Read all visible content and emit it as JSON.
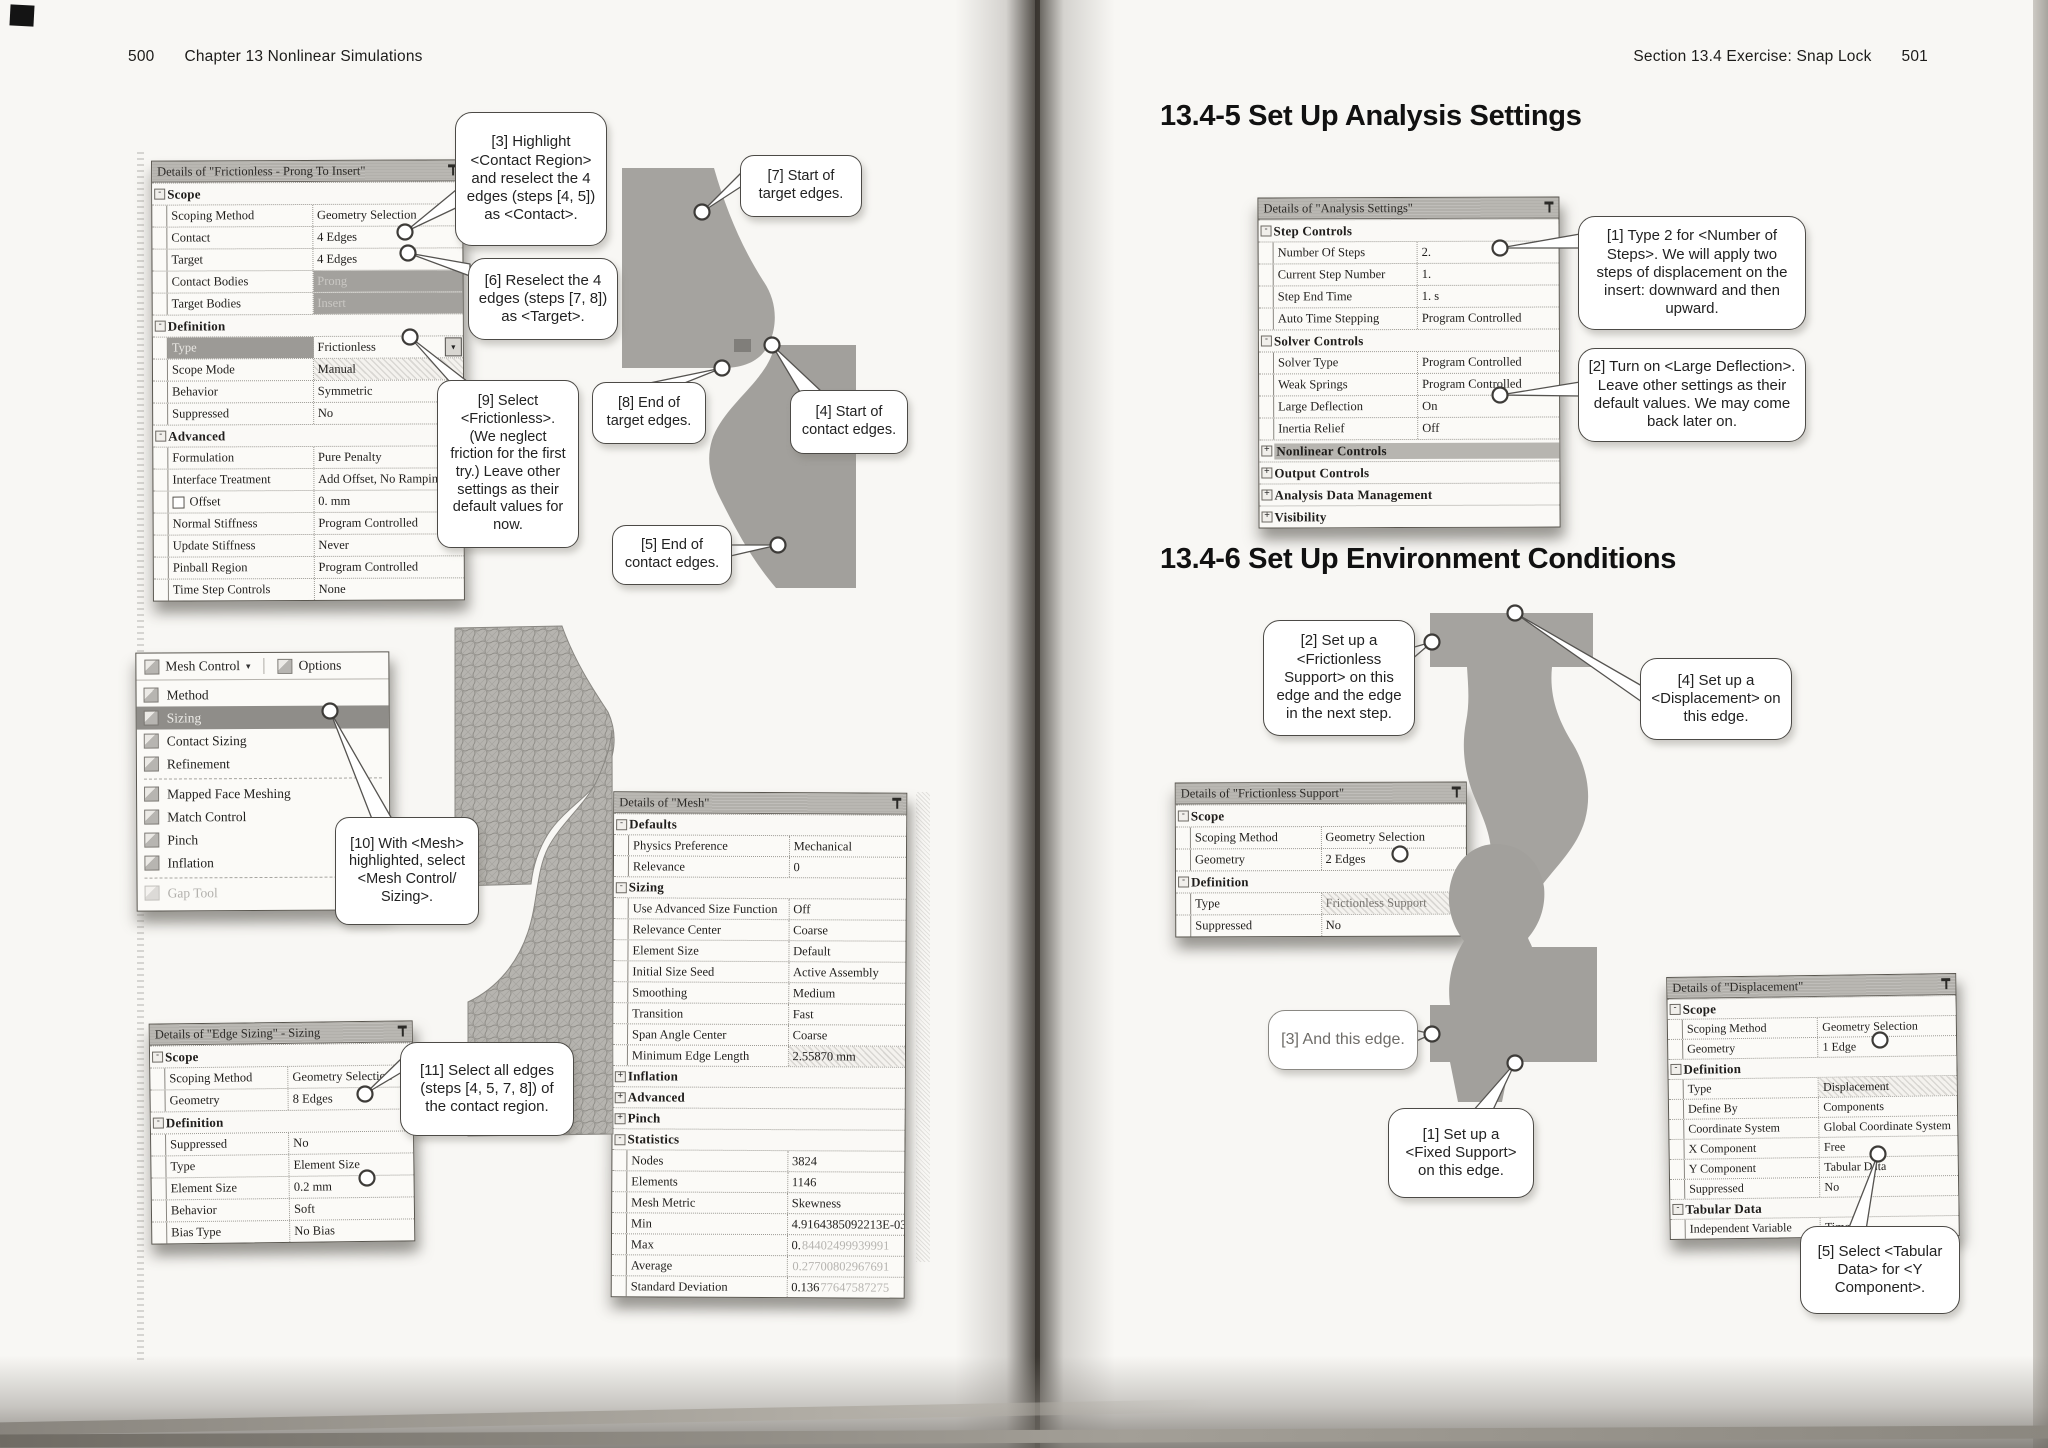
{
  "page_left": {
    "page_number": "500",
    "running_head": "Chapter 13  Nonlinear Simulations"
  },
  "page_right": {
    "running_head": "Section 13.4  Exercise:  Snap Lock",
    "page_number": "501",
    "heading_1345": "13.4-5  Set Up Analysis Settings",
    "heading_1346": "13.4-6  Set Up Environment Conditions"
  },
  "tables": {
    "contact": {
      "title": "Details of \"Frictionless - Prong To Insert\"",
      "rows": [
        {
          "t": "sec",
          "l": "Scope",
          "e": "-"
        },
        {
          "t": "row",
          "l": "Scoping Method",
          "v": "Geometry Selection"
        },
        {
          "t": "row",
          "l": "Contact",
          "v": "4 Edges"
        },
        {
          "t": "row",
          "l": "Target",
          "v": "4 Edges"
        },
        {
          "t": "row",
          "l": "Contact Bodies",
          "v": "Prong",
          "vs": "gray"
        },
        {
          "t": "row",
          "l": "Target Bodies",
          "v": "Insert",
          "vs": "gray"
        },
        {
          "t": "sec",
          "l": "Definition",
          "e": "-"
        },
        {
          "t": "row",
          "l": "Type",
          "v": "Frictionless",
          "lhl": true,
          "dd": true
        },
        {
          "t": "row",
          "l": "Scope Mode",
          "v": "Manual",
          "vs": "hatch"
        },
        {
          "t": "row",
          "l": "Behavior",
          "v": "Symmetric"
        },
        {
          "t": "row",
          "l": "Suppressed",
          "v": "No"
        },
        {
          "t": "sec",
          "l": "Advanced",
          "e": "-"
        },
        {
          "t": "row",
          "l": "Formulation",
          "v": "Pure Penalty"
        },
        {
          "t": "row",
          "l": "Interface Treatment",
          "v": "Add Offset, No Ramping"
        },
        {
          "t": "row",
          "l": "Offset",
          "v": "0. mm",
          "cb": true
        },
        {
          "t": "row",
          "l": "Normal Stiffness",
          "v": "Program Controlled"
        },
        {
          "t": "row",
          "l": "Update Stiffness",
          "v": "Never"
        },
        {
          "t": "row",
          "l": "Pinball Region",
          "v": "Program Controlled"
        },
        {
          "t": "row",
          "l": "Time Step Controls",
          "v": "None"
        }
      ]
    },
    "edge_sizing": {
      "title": "Details of \"Edge Sizing\" - Sizing",
      "rows": [
        {
          "t": "sec",
          "l": "Scope",
          "e": "-"
        },
        {
          "t": "row",
          "l": "Scoping Method",
          "v": "Geometry Selection"
        },
        {
          "t": "row",
          "l": "Geometry",
          "v": "8 Edges"
        },
        {
          "t": "sec",
          "l": "Definition",
          "e": "-"
        },
        {
          "t": "row",
          "l": "Suppressed",
          "v": "No"
        },
        {
          "t": "row",
          "l": "Type",
          "v": "Element Size"
        },
        {
          "t": "row",
          "l": "Element Size",
          "v": "0.2 mm"
        },
        {
          "t": "row",
          "l": "Behavior",
          "v": "Soft"
        },
        {
          "t": "row",
          "l": "Bias Type",
          "v": "No Bias"
        }
      ]
    },
    "mesh": {
      "title": "Details of \"Mesh\"",
      "rows": [
        {
          "t": "sec",
          "l": "Defaults",
          "e": "-"
        },
        {
          "t": "row",
          "l": "Physics Preference",
          "v": "Mechanical"
        },
        {
          "t": "row",
          "l": "Relevance",
          "v": "0"
        },
        {
          "t": "sec",
          "l": "Sizing",
          "e": "-"
        },
        {
          "t": "row",
          "l": "Use Advanced Size Function",
          "v": "Off"
        },
        {
          "t": "row",
          "l": "Relevance Center",
          "v": "Coarse"
        },
        {
          "t": "row",
          "l": "Element Size",
          "v": "Default"
        },
        {
          "t": "row",
          "l": "Initial Size Seed",
          "v": "Active Assembly"
        },
        {
          "t": "row",
          "l": "Smoothing",
          "v": "Medium"
        },
        {
          "t": "row",
          "l": "Transition",
          "v": "Fast"
        },
        {
          "t": "row",
          "l": "Span Angle Center",
          "v": "Coarse"
        },
        {
          "t": "row",
          "l": "Minimum Edge Length",
          "v": "2.55870 mm",
          "vs": "hatch"
        },
        {
          "t": "sec",
          "l": "Inflation",
          "e": "+"
        },
        {
          "t": "sec",
          "l": "Advanced",
          "e": "+"
        },
        {
          "t": "sec",
          "l": "Pinch",
          "e": "+"
        },
        {
          "t": "sec",
          "l": "Statistics",
          "e": "-"
        },
        {
          "t": "row",
          "l": "Nodes",
          "v": "3824"
        },
        {
          "t": "row",
          "l": "Elements",
          "v": "1146"
        },
        {
          "t": "row",
          "l": "Mesh Metric",
          "v": "Skewness"
        },
        {
          "t": "row",
          "l": "Min",
          "v": "4.9164385092213E-03"
        },
        {
          "t": "row",
          "l": "Max",
          "v": "0.",
          "vdim": "84402499939991"
        },
        {
          "t": "row",
          "l": "Average",
          "v": "",
          "vdim": "0.27700802967691"
        },
        {
          "t": "row",
          "l": "Standard Deviation",
          "v": "0.136",
          "vdim": "77647587275"
        }
      ]
    },
    "analysis": {
      "title": "Details of \"Analysis Settings\"",
      "rows": [
        {
          "t": "sec",
          "l": "Step Controls",
          "e": "-"
        },
        {
          "t": "row",
          "l": "Number Of Steps",
          "v": "2."
        },
        {
          "t": "row",
          "l": "Current Step Number",
          "v": "1."
        },
        {
          "t": "row",
          "l": "Step End Time",
          "v": "1. s"
        },
        {
          "t": "row",
          "l": "Auto Time Stepping",
          "v": "Program Controlled"
        },
        {
          "t": "sec",
          "l": "Solver Controls",
          "e": "-"
        },
        {
          "t": "row",
          "l": "Solver Type",
          "v": "Program Controlled"
        },
        {
          "t": "row",
          "l": "Weak Springs",
          "v": "Program Controlled"
        },
        {
          "t": "row",
          "l": "Large Deflection",
          "v": "On"
        },
        {
          "t": "row",
          "l": "Inertia Relief",
          "v": "Off"
        },
        {
          "t": "sec",
          "l": "Nonlinear Controls",
          "e": "+",
          "hl": true
        },
        {
          "t": "sec",
          "l": "Output Controls",
          "e": "+"
        },
        {
          "t": "sec",
          "l": "Analysis Data Management",
          "e": "+"
        },
        {
          "t": "sec",
          "l": "Visibility",
          "e": "+"
        }
      ]
    },
    "frictionless_support": {
      "title": "Details of \"Frictionless Support\"",
      "rows": [
        {
          "t": "sec",
          "l": "Scope",
          "e": "-"
        },
        {
          "t": "row",
          "l": "Scoping Method",
          "v": "Geometry Selection"
        },
        {
          "t": "row",
          "l": "Geometry",
          "v": "2 Edges"
        },
        {
          "t": "sec",
          "l": "Definition",
          "e": "-"
        },
        {
          "t": "row",
          "l": "Type",
          "v": "Frictionless Support",
          "vs": "hatchdim"
        },
        {
          "t": "row",
          "l": "Suppressed",
          "v": "No"
        }
      ]
    },
    "displacement": {
      "title": "Details of \"Displacement\"",
      "rows": [
        {
          "t": "sec",
          "l": "Scope",
          "e": "-"
        },
        {
          "t": "row",
          "l": "Scoping Method",
          "v": "Geometry Selection"
        },
        {
          "t": "row",
          "l": "Geometry",
          "v": "1 Edge"
        },
        {
          "t": "sec",
          "l": "Definition",
          "e": "-"
        },
        {
          "t": "row",
          "l": "Type",
          "v": "Displacement",
          "vs": "hatch"
        },
        {
          "t": "row",
          "l": "Define By",
          "v": "Components"
        },
        {
          "t": "row",
          "l": "Coordinate System",
          "v": "Global Coordinate System"
        },
        {
          "t": "row",
          "l": "X Component",
          "v": "Free"
        },
        {
          "t": "row",
          "l": "Y Component",
          "v": "Tabular Data"
        },
        {
          "t": "row",
          "l": "Suppressed",
          "v": "No"
        },
        {
          "t": "sec",
          "l": "Tabular Data",
          "e": "-"
        },
        {
          "t": "row",
          "l": "Independent Variable",
          "v": "Time"
        }
      ]
    }
  },
  "mesh_menu": {
    "toolbar_mesh_control": "Mesh Control",
    "toolbar_options": "Options",
    "items": [
      {
        "label": "Method",
        "icon": "method-icon"
      },
      {
        "label": "Sizing",
        "icon": "sizing-icon",
        "state": "hl"
      },
      {
        "label": "Contact Sizing",
        "icon": "contact-sizing-icon"
      },
      {
        "label": "Refinement",
        "icon": "refinement-icon",
        "sep": true
      },
      {
        "label": "Mapped Face Meshing",
        "icon": "mapped-face-meshing-icon"
      },
      {
        "label": "Match Control",
        "icon": "match-control-icon"
      },
      {
        "label": "Pinch",
        "icon": "pinch-icon"
      },
      {
        "label": "Inflation",
        "icon": "inflation-icon",
        "sep": true
      },
      {
        "label": "Gap Tool",
        "icon": "gap-tool-icon",
        "state": "dis"
      }
    ]
  },
  "callouts": {
    "c3": "[3] Highlight <Contact Region> and reselect the 4 edges (steps [4, 5]) as <Contact>.",
    "c6": "[6] Reselect the 4 edges (steps [7, 8]) as <Target>.",
    "c9": "[9] Select <Frictionless>. (We neglect friction for the first try.)  Leave other settings as their default values for now.",
    "c7": "[7] Start of target edges.",
    "c8": "[8] End of target edges.",
    "c4": "[4] Start of contact edges.",
    "c5": "[5] End of contact edges.",
    "c10": "[10] With <Mesh> highlighted, select <Mesh Control/ Sizing>.",
    "c11": "[11] Select all edges (steps [4, 5, 7, 8]) of the contact region.",
    "a1": "[1] Type 2 for <Number of Steps>. We will apply two steps of displacement on the insert: downward and then upward.",
    "a2": "[2] Turn on <Large Deflection>. Leave other settings as their default values. We may come back later on.",
    "e2": "[2] Set up a <Frictionless Support> on this edge and the edge in the next step.",
    "e4": "[4] Set up a <Displacement> on this edge.",
    "e3": "[3] And this edge.",
    "e1": "[1] Set up a <Fixed Support> on this edge.",
    "d5": "[5] Select <Tabular Data> for <Y Component>."
  }
}
